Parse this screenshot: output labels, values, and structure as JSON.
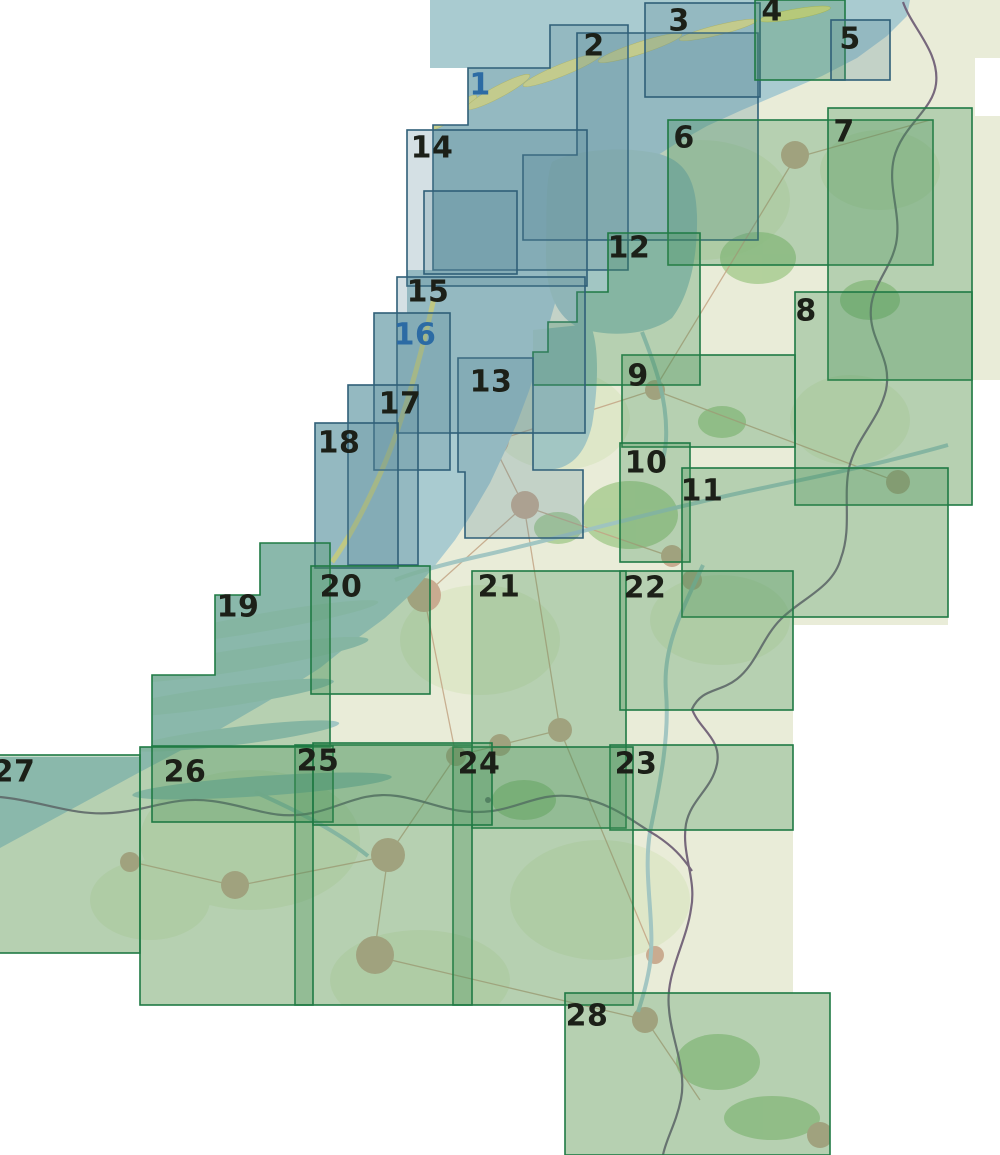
{
  "page": {
    "background": "#ffffff"
  },
  "map": {
    "sheet_numbers_visible": [
      "1",
      "2",
      "3",
      "4",
      "5",
      "6",
      "7",
      "8",
      "9",
      "10",
      "11",
      "12",
      "13",
      "14",
      "15",
      "16",
      "17",
      "18",
      "19",
      "20",
      "21",
      "22",
      "23",
      "24",
      "25",
      "26",
      "27",
      "28"
    ],
    "colors": {
      "page_white": "#ffffff",
      "land_base": "#e9ecd8",
      "field_blob": "#dde7c6",
      "forest_blob": "#a9cd92",
      "town_blob": "#c9ab90",
      "road_line": "#c3a585",
      "sea": "#a9cbd0",
      "lake": "#a2c6c3",
      "dune_yellow": "#e8e38a",
      "country_border": "#6a5a72",
      "green_sheet_fill": "rgba(66,142,85,0.30)",
      "green_sheet_stroke": "#1f7a44",
      "blue_sheet_fill": "rgba(88,136,150,0.26)",
      "blue_sheet_stroke": "#2f5f78",
      "label_dark": "#1c2018",
      "label_blue": "#2c6ba4"
    },
    "label_font_px": 30,
    "sheets": [
      {
        "label": "1",
        "series": "blue",
        "shape": "poly",
        "points": [
          [
            550,
            25
          ],
          [
            628,
            25
          ],
          [
            628,
            270
          ],
          [
            433,
            270
          ],
          [
            433,
            125
          ],
          [
            468,
            125
          ],
          [
            468,
            68
          ],
          [
            550,
            68
          ]
        ],
        "label_pos": [
          480,
          85
        ],
        "label_style": "blue"
      },
      {
        "label": "2",
        "series": "blue",
        "shape": "poly",
        "points": [
          [
            577,
            33
          ],
          [
            758,
            33
          ],
          [
            758,
            240
          ],
          [
            523,
            240
          ],
          [
            523,
            155
          ],
          [
            577,
            155
          ]
        ],
        "label_pos": [
          594,
          46
        ],
        "label_style": "dark"
      },
      {
        "label": "3",
        "series": "blue",
        "shape": "rect",
        "rect": [
          645,
          3,
          115,
          94
        ],
        "label_pos": [
          679,
          21
        ],
        "label_style": "dark"
      },
      {
        "label": "4",
        "series": "green",
        "shape": "rect",
        "rect": [
          755,
          0,
          90,
          80
        ],
        "label_pos": [
          772,
          11
        ],
        "label_style": "dark"
      },
      {
        "label": "5",
        "series": "blue",
        "shape": "rect",
        "rect": [
          831,
          20,
          59,
          60
        ],
        "label_pos": [
          850,
          39
        ],
        "label_style": "dark"
      },
      {
        "label": "6",
        "series": "green",
        "shape": "rect",
        "rect": [
          668,
          120,
          265,
          145
        ],
        "label_pos": [
          684,
          138
        ],
        "label_style": "dark"
      },
      {
        "label": "7",
        "series": "green",
        "shape": "rect",
        "rect": [
          828,
          108,
          144,
          272
        ],
        "label_pos": [
          844,
          132
        ],
        "label_style": "dark"
      },
      {
        "label": "8",
        "series": "green",
        "shape": "rect",
        "rect": [
          795,
          292,
          177,
          213
        ],
        "label_pos": [
          806,
          311
        ],
        "label_style": "dark"
      },
      {
        "label": "9",
        "series": "green",
        "shape": "rect",
        "rect": [
          622,
          355,
          173,
          92
        ],
        "label_pos": [
          638,
          376
        ],
        "label_style": "dark"
      },
      {
        "label": "10",
        "series": "green",
        "shape": "rect",
        "rect": [
          620,
          443,
          70,
          119
        ],
        "label_pos": [
          646,
          463
        ],
        "label_style": "dark"
      },
      {
        "label": "11",
        "series": "green",
        "shape": "rect",
        "rect": [
          682,
          468,
          266,
          149
        ],
        "label_pos": [
          702,
          491
        ],
        "label_style": "dark"
      },
      {
        "label": "12",
        "series": "green",
        "shape": "poly",
        "points": [
          [
            608,
            233
          ],
          [
            700,
            233
          ],
          [
            700,
            385
          ],
          [
            533,
            385
          ],
          [
            533,
            352
          ],
          [
            548,
            352
          ],
          [
            548,
            322
          ],
          [
            577,
            322
          ],
          [
            577,
            292
          ],
          [
            608,
            292
          ]
        ],
        "label_pos": [
          629,
          248
        ],
        "label_style": "dark"
      },
      {
        "label": "13",
        "series": "blue",
        "shape": "poly",
        "points": [
          [
            458,
            358
          ],
          [
            533,
            358
          ],
          [
            533,
            470
          ],
          [
            583,
            470
          ],
          [
            583,
            538
          ],
          [
            465,
            538
          ],
          [
            465,
            472
          ],
          [
            458,
            472
          ]
        ],
        "label_pos": [
          491,
          382
        ],
        "label_style": "dark"
      },
      {
        "label": "14",
        "series": "blue",
        "shape": "rect",
        "rect": [
          407,
          130,
          180,
          156
        ],
        "label_pos": [
          432,
          148
        ],
        "label_style": "dark"
      },
      {
        "label": "15",
        "series": "blue",
        "shape": "rect",
        "rect": [
          397,
          277,
          188,
          156
        ],
        "label_pos": [
          428,
          292
        ],
        "label_style": "dark"
      },
      {
        "label": "16",
        "series": "blue",
        "shape": "rect",
        "rect": [
          374,
          313,
          76,
          157
        ],
        "label_pos": [
          415,
          335
        ],
        "label_style": "blue"
      },
      {
        "label": "17",
        "series": "blue",
        "shape": "rect",
        "rect": [
          348,
          385,
          70,
          180
        ],
        "label_pos": [
          400,
          404
        ],
        "label_style": "dark"
      },
      {
        "label": "18",
        "series": "blue",
        "shape": "rect",
        "rect": [
          315,
          423,
          83,
          145
        ],
        "label_pos": [
          339,
          443
        ],
        "label_style": "dark"
      },
      {
        "label": "19",
        "series": "green",
        "shape": "poly",
        "points": [
          [
            260,
            543
          ],
          [
            330,
            543
          ],
          [
            330,
            747
          ],
          [
            152,
            747
          ],
          [
            152,
            675
          ],
          [
            215,
            675
          ],
          [
            215,
            595
          ],
          [
            260,
            595
          ]
        ],
        "label_pos": [
          238,
          607
        ],
        "label_style": "dark"
      },
      {
        "label": "20",
        "series": "green",
        "shape": "rect",
        "rect": [
          311,
          566,
          119,
          128
        ],
        "label_pos": [
          341,
          587
        ],
        "label_style": "dark"
      },
      {
        "label": "21",
        "series": "green",
        "shape": "rect",
        "rect": [
          472,
          571,
          154,
          257
        ],
        "label_pos": [
          499,
          587
        ],
        "label_style": "dark"
      },
      {
        "label": "22",
        "series": "green",
        "shape": "rect",
        "rect": [
          620,
          571,
          173,
          139
        ],
        "label_pos": [
          645,
          588
        ],
        "label_style": "dark"
      },
      {
        "label": "23",
        "series": "green",
        "shape": "rect",
        "rect": [
          610,
          745,
          183,
          85
        ],
        "label_pos": [
          636,
          764
        ],
        "label_style": "dark"
      },
      {
        "label": "24",
        "series": "green",
        "shape": "rect",
        "rect": [
          453,
          747,
          180,
          258
        ],
        "label_pos": [
          479,
          764
        ],
        "label_style": "dark"
      },
      {
        "label": "25",
        "series": "green",
        "shape": "rect",
        "rect": [
          295,
          745,
          177,
          260
        ],
        "label_pos": [
          318,
          761
        ],
        "label_style": "dark"
      },
      {
        "label": "26",
        "series": "green",
        "shape": "rect",
        "rect": [
          140,
          747,
          173,
          258
        ],
        "label_pos": [
          185,
          772
        ],
        "label_style": "dark"
      },
      {
        "label": "27",
        "series": "green",
        "shape": "rect",
        "rect": [
          -62,
          755,
          202,
          198
        ],
        "label_pos": [
          14,
          772
        ],
        "label_style": "dark"
      },
      {
        "label": "28",
        "series": "green",
        "shape": "rect",
        "rect": [
          565,
          993,
          265,
          162
        ],
        "label_pos": [
          587,
          1016
        ],
        "label_style": "dark"
      },
      {
        "label": "",
        "series": "blue",
        "shape": "rect",
        "rect": [
          424,
          191,
          93,
          83
        ],
        "label_pos": null,
        "label_style": "dark"
      },
      {
        "label": "",
        "series": "green",
        "shape": "rect",
        "rect": [
          152,
          746,
          181,
          76
        ],
        "label_pos": null,
        "label_style": "dark"
      },
      {
        "label": "",
        "series": "green",
        "shape": "rect",
        "rect": [
          313,
          743,
          179,
          82
        ],
        "label_pos": null,
        "label_style": "dark"
      }
    ]
  }
}
